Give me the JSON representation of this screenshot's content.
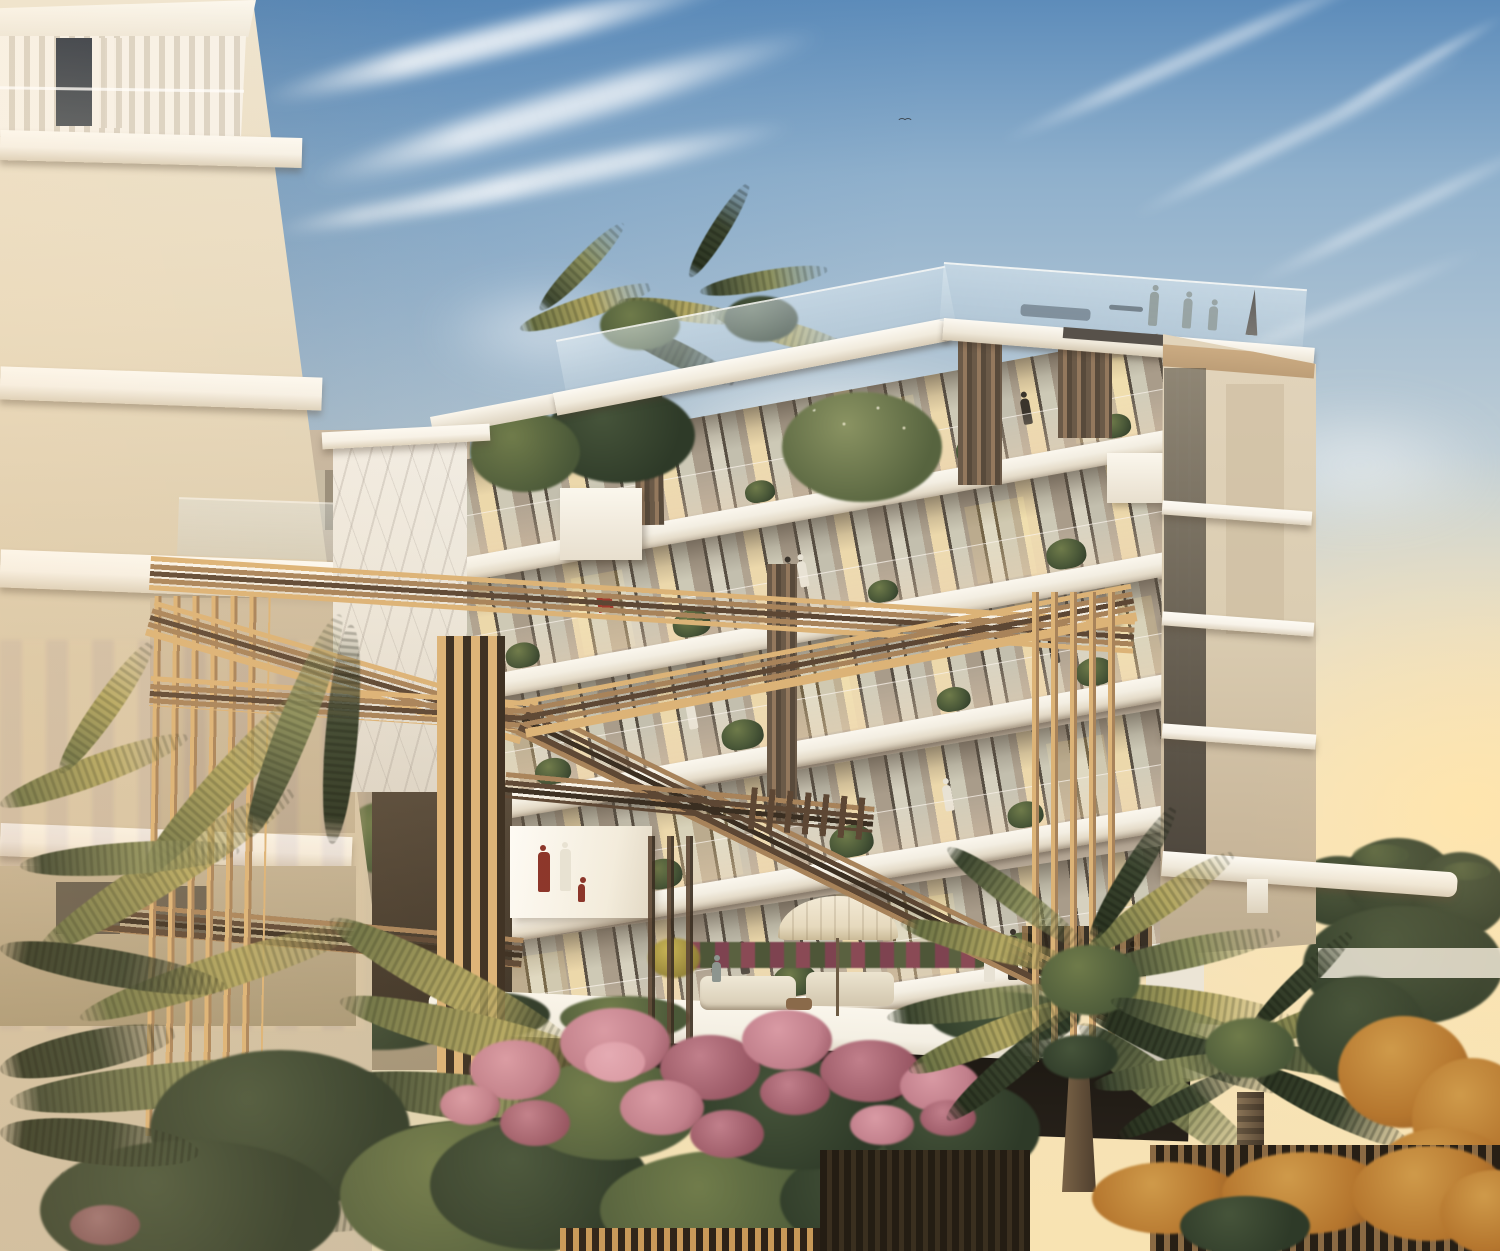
{
  "scene": {
    "label": "Sunset architectural rendering of a modern luxury apartment complex with tiered white balconies, a sculptural golden slatted pergola, rooftop terrace with people, and tropical landscaping of palms and pink flowering shrubs",
    "time_of_day": "sunset",
    "floors_visible": 6,
    "people_on_rooftop": 4,
    "people_on_terrace": 8
  },
  "palette": {
    "sky-top": "#5d8cba",
    "sky-high": "#8fb0cc",
    "sky-mid": "#c7d2d6",
    "sky-low": "#ecdfc8",
    "sky-warm": "#f6e2b6",
    "sun-glow": "#ffe7b0",
    "lb-wall-1": "#efe6d2",
    "lb-wall-2": "#d9c9ab",
    "band-white": "#f7f2e8",
    "wall-greige": "#b5a795",
    "frame": "#574e42",
    "glass-cool": "#d6d1bf",
    "glass-warm": "#ecd8ab",
    "glass-dim": "#c3bfae",
    "pier": "#b0a390",
    "slab-top": "#f3eee2",
    "tower-side": "#e2d4bb",
    "tower-dark": "#c9b79b",
    "tan-band": "#bd9e77",
    "slot": "#4e473d",
    "marble": "#ece6da",
    "pg-lit": "#dcb377",
    "pg-mid": "#a8835a",
    "pg-dark": "#5d4734",
    "pg-deep": "#3a2e21",
    "terr-white": "#f4efe3",
    "terr-shadow": "#1c1812",
    "fig-dark": "#3a342c",
    "fig-red": "#8a3328",
    "fig-white": "#e8e2d4",
    "palm-lit": "#b4a862",
    "palm-mid": "#6c7345",
    "palm-dark": "#3c4630",
    "palm-sage": "#8b8f5c",
    "pink": "#c17f8b",
    "pink-d": "#94525f",
    "pink-l": "#d99aa4",
    "grn-d": "#2e3a28",
    "grn-m": "#4a5838",
    "grn-l": "#6f7b4a",
    "rust": "#b5762e",
    "rust-d": "#8a5424",
    "treeline": "#343f2b",
    "umb": "#e6d9bd",
    "umb-grey": "#b7b0a3",
    "trunk": "#6f5b43"
  },
  "elements": {
    "left_tower": "Cream corner tower with rooftop curtained loggia and white balcony bands",
    "main_building": "Six-storey stepped apartment facade with floor-to-ceiling glazing, white slabs and planted balconies",
    "rooftop_terrace": "Glass-railed roof terrace with people, parasol and roof garden palms",
    "pergola": "Golden slatted sculptural pergola with crossing beams and vertical fin clusters",
    "terrace": "Pool-deck terrace with umbrellas, lounge sofas and residents",
    "vegetation": "Foreground date palms, pink albizia blossom shrubs, rust grasses and hedges",
    "sky": "Sunset sky with blue zenith, cirrus streaks and warm horizon glow"
  }
}
